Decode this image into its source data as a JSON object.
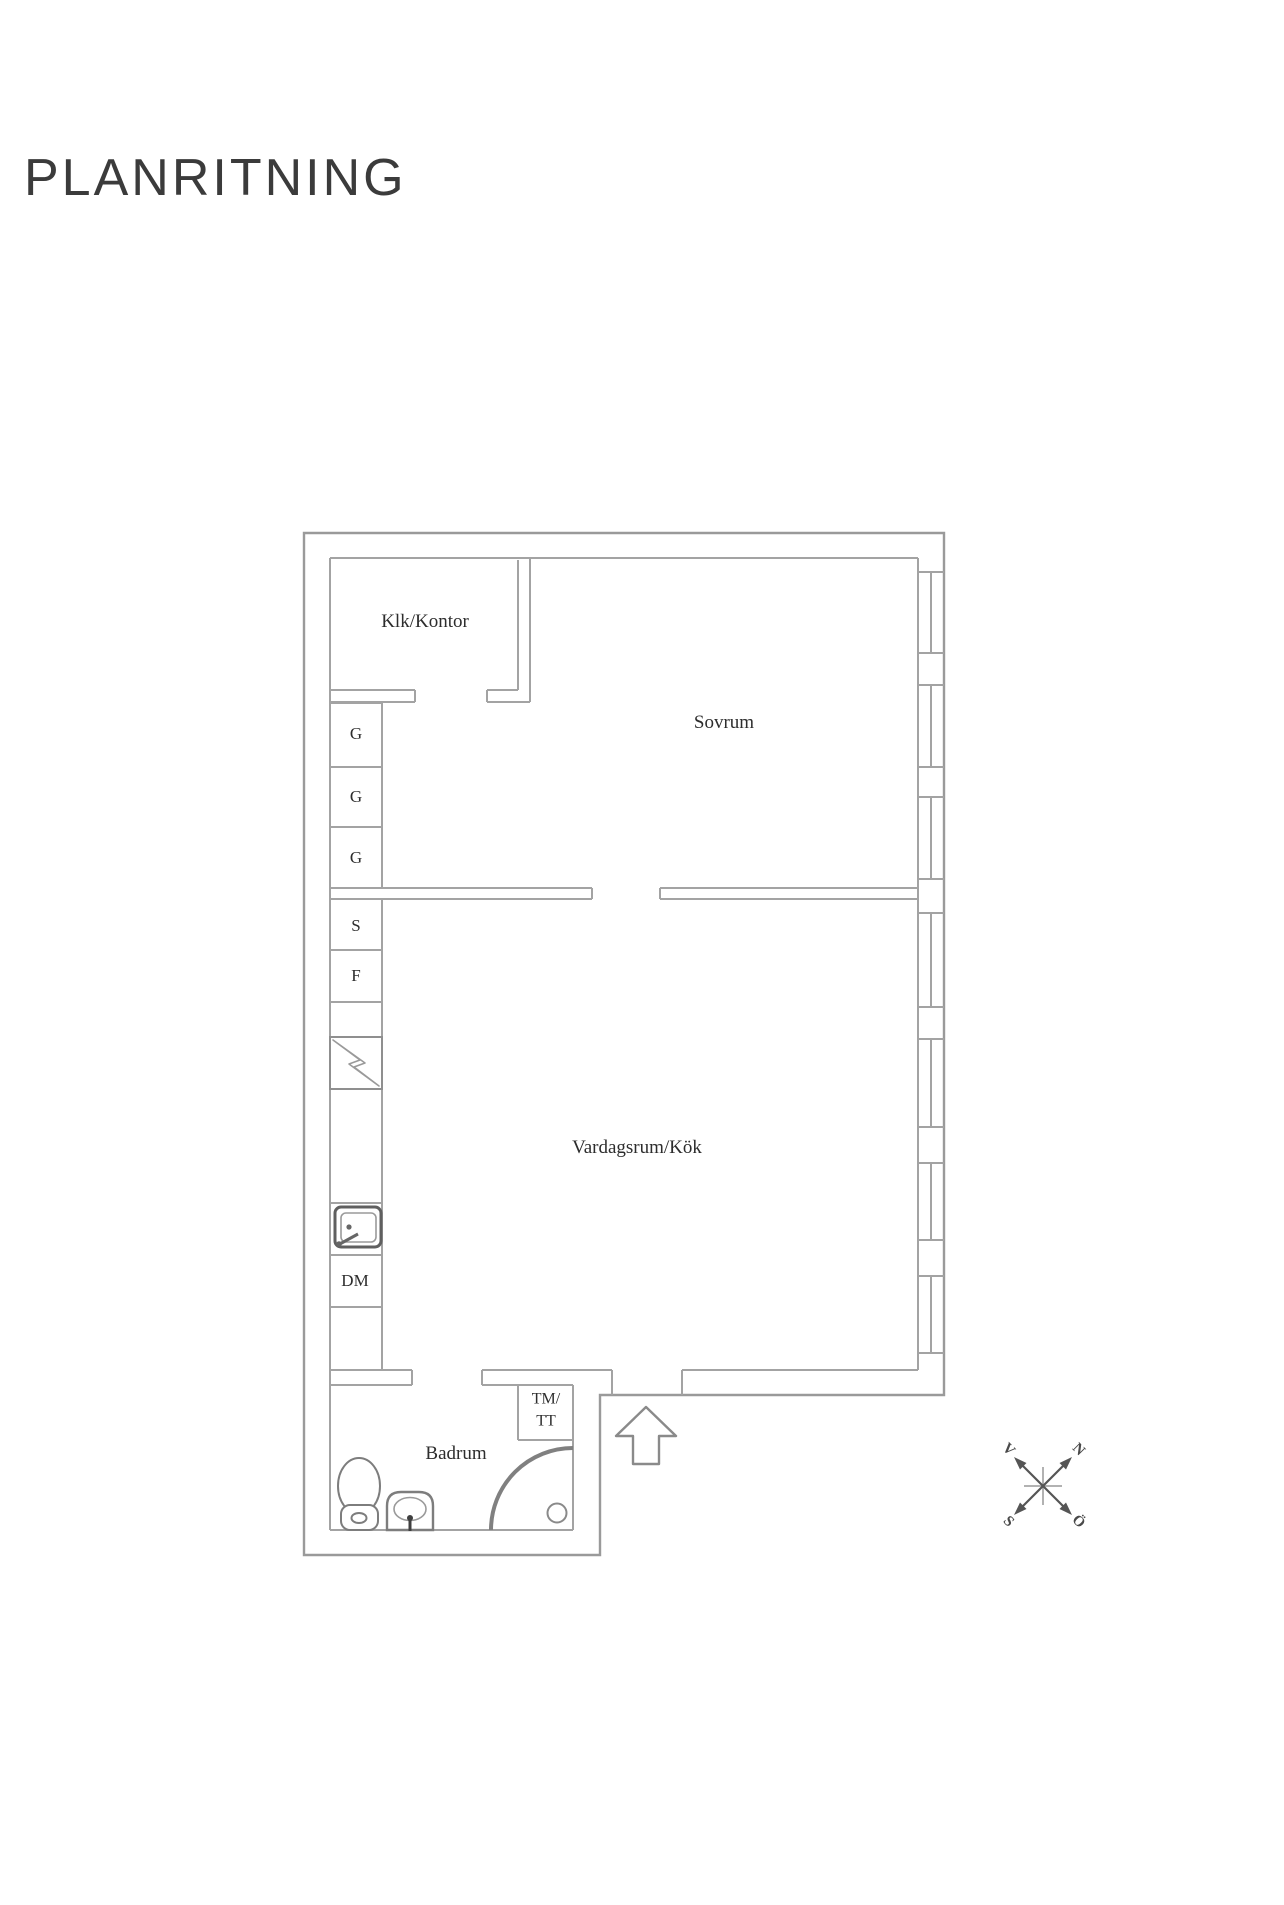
{
  "title": "PLANRITNING",
  "plan": {
    "rooms": {
      "klk_kontor": "Klk/Kontor",
      "sovrum": "Sovrum",
      "vardagsrum_kok": "Vardagsrum/Kök",
      "badrum": "Badrum"
    },
    "cabinets": {
      "g1": "G",
      "g2": "G",
      "g3": "G",
      "s": "S",
      "f": "F",
      "dm": "DM",
      "tm_line1": "TM/",
      "tm_line2": "TT"
    },
    "fixture_icons": [
      "stove-icon",
      "kitchen-sink-icon",
      "toilet-icon",
      "washbasin-icon",
      "shower-door-icon",
      "entrance-arrow-icon"
    ],
    "window_count": 7
  },
  "compass": {
    "north": "N",
    "west": "V",
    "south": "S",
    "east": "Ö"
  },
  "colors": {
    "background": "#ffffff",
    "wall_line": "#a3a3a3",
    "furniture_line": "#7d7d7d",
    "shower_arc": "#808080",
    "text": "#2d2d2d",
    "title_text": "#3b3b3b",
    "compass": "#555555"
  }
}
